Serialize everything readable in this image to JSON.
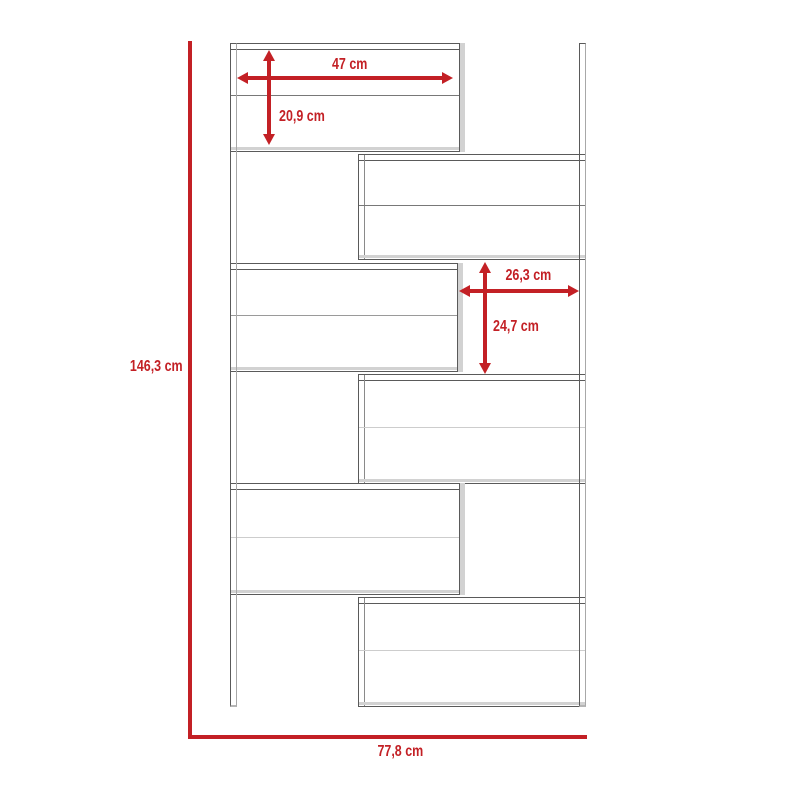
{
  "diagram": {
    "kind": "furniture-dimension-drawing",
    "labels": {
      "overall_height": "146,3 cm",
      "overall_width": "77,8 cm",
      "shelf_width": "47 cm",
      "shelf_height": "20,9 cm",
      "cubby_width": "26,3 cm",
      "cubby_height": "24,7 cm"
    }
  },
  "colors": {
    "dimension_red": "#c32025",
    "outline_dark": "#5a5a5a",
    "outline_light": "#d2d2d2"
  }
}
